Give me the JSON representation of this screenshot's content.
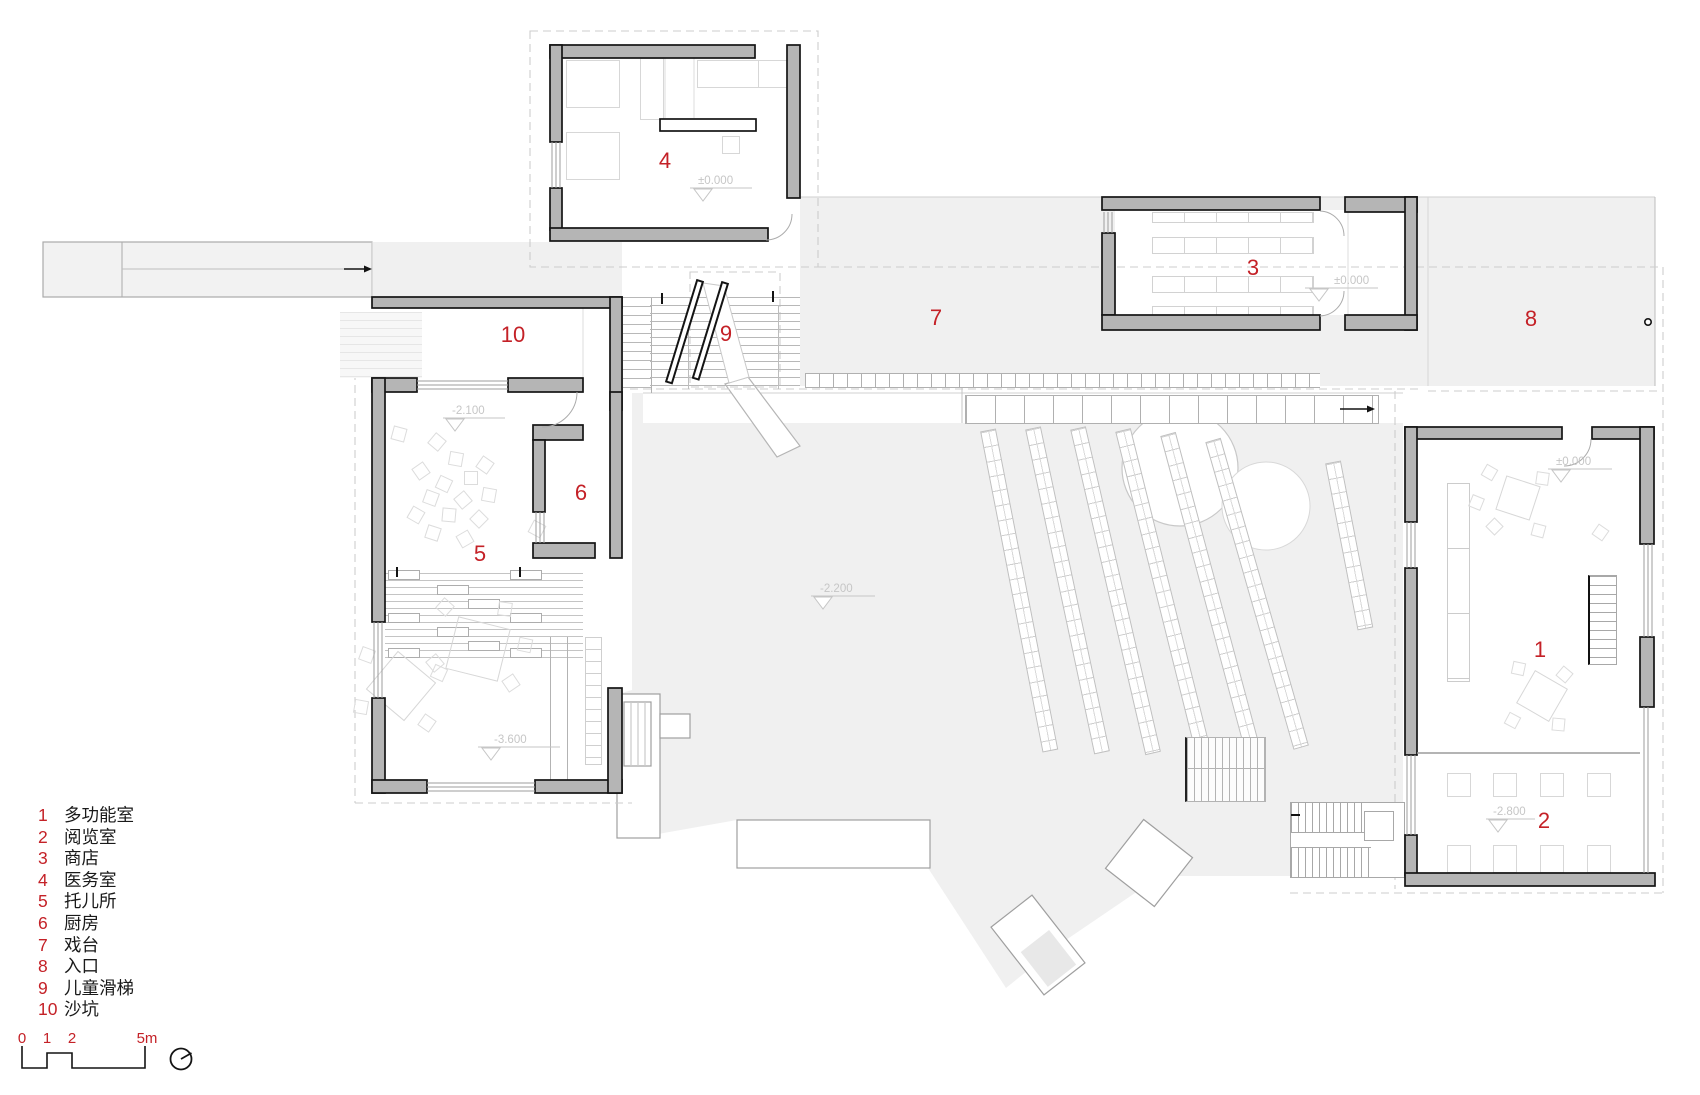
{
  "colors": {
    "wall_fill": "#b5b5b5",
    "wall_outline": "#141414",
    "area_fill": "#f0f0f0",
    "accent_red": "#c42127",
    "marker_gray": "#c6c6c6"
  },
  "legend": {
    "items": [
      {
        "num": "1",
        "label": "多功能室"
      },
      {
        "num": "2",
        "label": "阅览室"
      },
      {
        "num": "3",
        "label": "商店"
      },
      {
        "num": "4",
        "label": "医务室"
      },
      {
        "num": "5",
        "label": "托儿所"
      },
      {
        "num": "6",
        "label": "厨房"
      },
      {
        "num": "7",
        "label": "戏台"
      },
      {
        "num": "8",
        "label": "入口"
      },
      {
        "num": "9",
        "label": "儿童滑梯"
      },
      {
        "num": "10",
        "label": "沙坑"
      }
    ]
  },
  "scale_bar": {
    "t0": "0",
    "t1": "1",
    "t2": "2",
    "t3": "5m"
  },
  "plan": {
    "room_labels": [
      {
        "text": "1"
      },
      {
        "text": "2"
      },
      {
        "text": "3"
      },
      {
        "text": "4"
      },
      {
        "text": "5"
      },
      {
        "text": "6"
      },
      {
        "text": "7"
      },
      {
        "text": "8"
      },
      {
        "text": "9"
      },
      {
        "text": "10"
      }
    ],
    "markers": [
      {
        "text": "±0.000"
      },
      {
        "text": "±0.000"
      },
      {
        "text": "±0.000"
      },
      {
        "text": "-2.100"
      },
      {
        "text": "-2.200"
      },
      {
        "text": "-3.600"
      },
      {
        "text": "-2.800"
      }
    ]
  }
}
